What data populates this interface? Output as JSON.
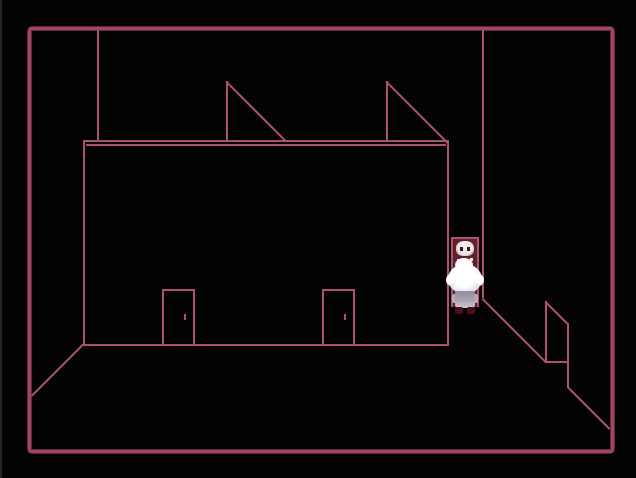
{
  "scene": {
    "name": "wireframe-room",
    "objects": [
      {
        "label": "room-border"
      },
      {
        "label": "facade-wall"
      },
      {
        "label": "facade-door-left"
      },
      {
        "label": "facade-door-right"
      },
      {
        "label": "roof-bracket-left"
      },
      {
        "label": "roof-bracket-right"
      },
      {
        "label": "back-corner-line-left"
      },
      {
        "label": "back-corner-line-right"
      },
      {
        "label": "floor-edge-left"
      },
      {
        "label": "floor-edge-right"
      },
      {
        "label": "side-wall-door"
      },
      {
        "label": "doorway-skull-picture"
      },
      {
        "label": "white-haired-character"
      }
    ]
  },
  "theme": {
    "screen-bg": "#030303",
    "border-pink": "#9e4569",
    "border-pink-dark": "#5e2740",
    "line-pink": "#ad5174",
    "door-maroon": "#63202b",
    "skull-white": "#efeaec",
    "skull-dark": "#40101c",
    "hair-white": "#ffffff",
    "hair-shade": "#b9b0be",
    "dress-grey": "#948d9f",
    "dress-light": "#cdc7d2",
    "shoe-maroon": "#4a1119",
    "edge-grey": "#272727"
  }
}
